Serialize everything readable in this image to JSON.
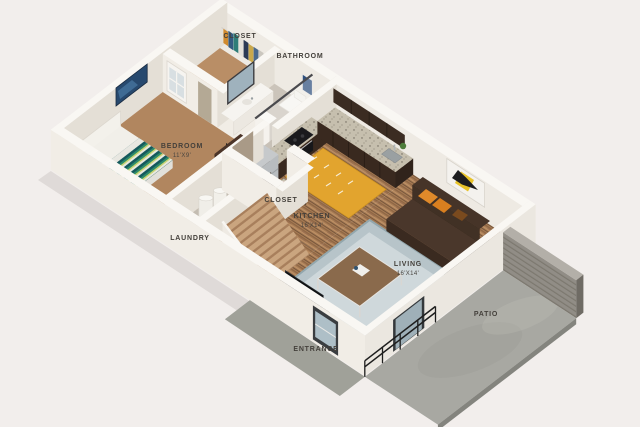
{
  "title": "3D apartment floor plan",
  "labels": {
    "closet_top": "CLOSET",
    "bathroom": "BATHROOM",
    "bedroom": "BEDROOM",
    "bedroom_dim": "11'X9'",
    "laundry": "LAUNDRY",
    "closet_mid": "CLOSET",
    "kitchen": "KITCHEN",
    "kitchen_dim": "16'X14'",
    "living": "LIVING",
    "living_dim": "16'X14'",
    "entrance": "ENTRANCE",
    "patio": "PATIO"
  },
  "colors": {
    "background": "#f2eeec",
    "wall_bright": "#f1ede6",
    "wall_shade": "#e4dfd6",
    "wall_top": "#f9f7f3",
    "carpet_bedroom": "#b1865f",
    "wood_floor": "#a87c55",
    "bath_floor": "#cbc4ba",
    "cabinet_espresso": "#39291f",
    "granite": "#c6bfae",
    "fridge_steel": "#a7acaf",
    "rug_yellow": "#e2a42e",
    "rug_living": "#b7c4c9",
    "sofa_brown": "#3a2a20",
    "pillow_orange": "#e08a2a",
    "bed_teal": "#15595d",
    "stairs_carpet": "#caa57f",
    "concrete": "#a8a8a2",
    "siding_gray": "#918d86",
    "label_text": "#44403b"
  }
}
